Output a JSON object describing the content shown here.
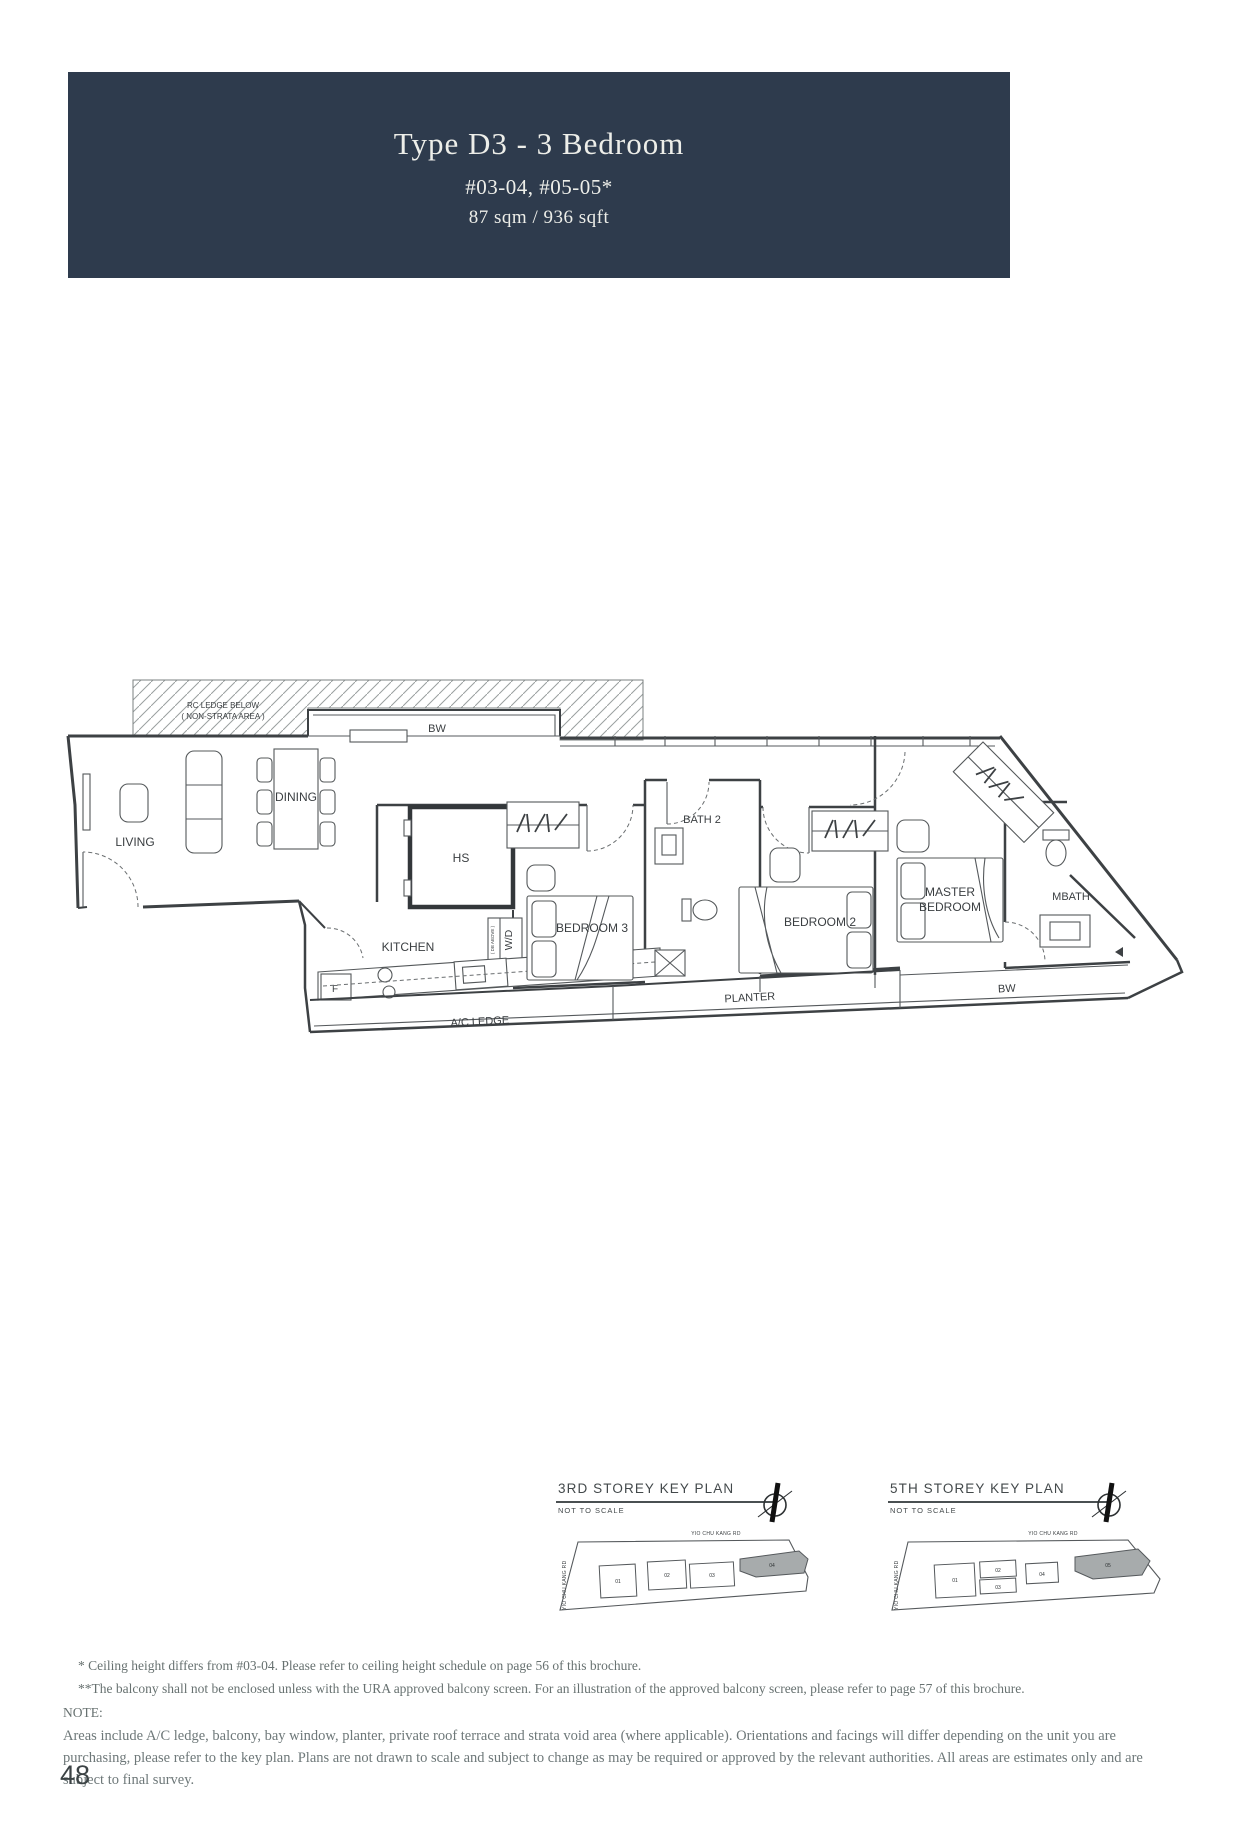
{
  "header": {
    "title": "Type D3 - 3 Bedroom",
    "unit_numbers": "#03-04, #05-05*",
    "area": "87 sqm / 936 sqft",
    "bg_color": "#2e3b4d"
  },
  "floorplan": {
    "labels": {
      "rc_ledge_1": "RC LEDGE BELOW",
      "rc_ledge_2": "( NON-STRATA AREA )",
      "bw_top": "BW",
      "living": "LIVING",
      "dining": "DINING",
      "kitchen": "KITCHEN",
      "hs": "HS",
      "wd": "W/D",
      "db_above": "( DB ABOVE )",
      "fridge": "F",
      "bedroom3": "BEDROOM 3",
      "bath2": "BATH 2",
      "bedroom2": "BEDROOM 2",
      "master_1": "MASTER",
      "master_2": "BEDROOM",
      "mbath": "MBATH",
      "planter": "PLANTER",
      "ac_ledge": "A/C LEDGE",
      "bw_bottom": "BW"
    }
  },
  "key_plans": [
    {
      "title": "3RD STOREY KEY PLAN",
      "subtitle": "NOT TO SCALE",
      "road_top": "YIO CHU KANG RD",
      "road_left": "YIO CHU KANG RD",
      "units": [
        "01",
        "02",
        "03",
        "04"
      ],
      "highlighted_unit": "04",
      "highlight_color": "#a7abac"
    },
    {
      "title": "5TH STOREY KEY PLAN",
      "subtitle": "NOT TO SCALE",
      "road_top": "YIO CHU KANG RD",
      "road_left": "YIO CHU KANG RD",
      "units": [
        "01",
        "02",
        "03",
        "04",
        "05"
      ],
      "highlighted_unit": "05",
      "highlight_color": "#a7abac"
    }
  ],
  "footnotes": [
    "* Ceiling height differs from #03-04. Please refer to ceiling height schedule on page 56 of this brochure.",
    "**The balcony shall not be enclosed unless with the URA approved balcony screen. For an illustration of the approved balcony screen, please refer to page 57 of this brochure."
  ],
  "note": {
    "heading": "NOTE:",
    "body": "Areas include A/C ledge, balcony, bay window, planter, private roof terrace and strata void area (where applicable). Orientations and facings will differ depending on the unit you are purchasing, please refer to the key plan. Plans are not drawn to scale and subject to change as may be required or approved by the relevant authorities. All areas are estimates only and are subject to final survey."
  },
  "page": {
    "number": "48"
  }
}
